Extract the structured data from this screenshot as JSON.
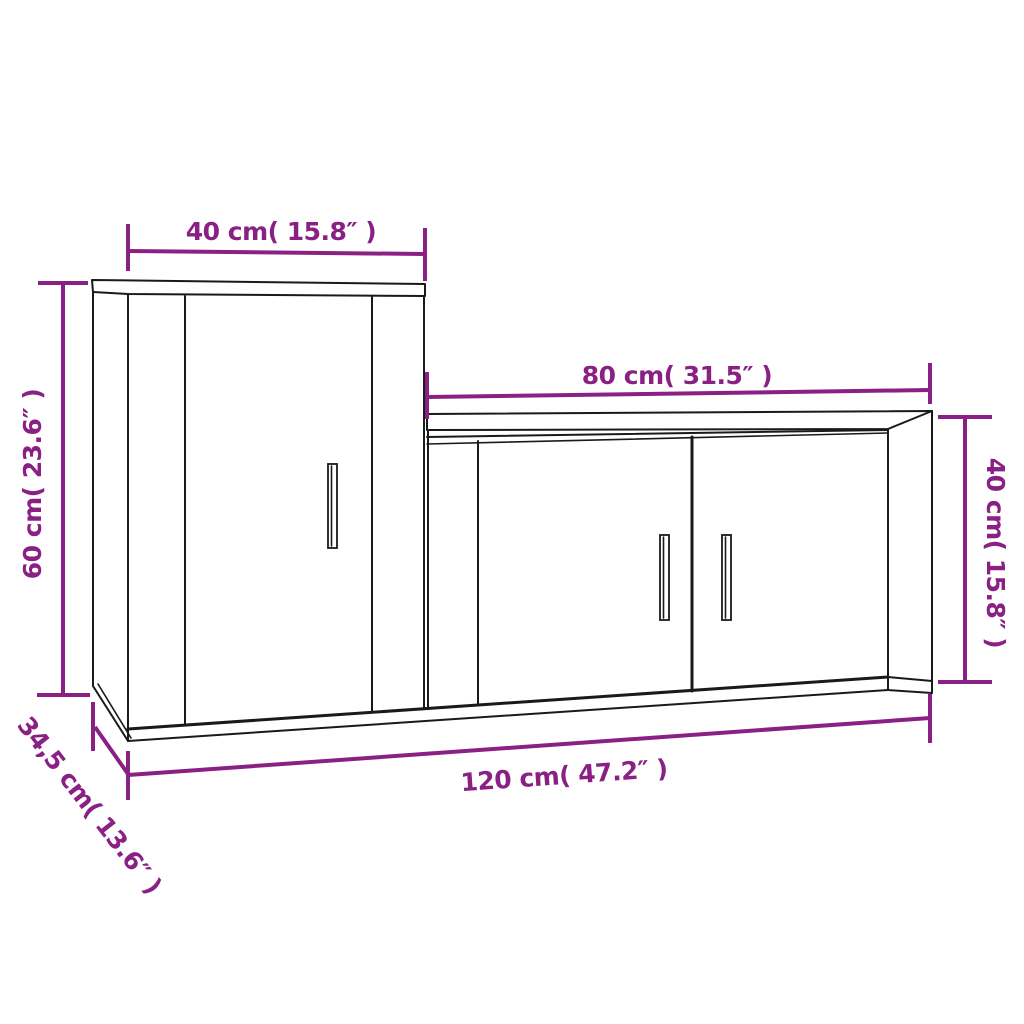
{
  "diagram": {
    "background": "#ffffff",
    "annotation_color": "#8A2084",
    "outline_color": "#1a1a1a",
    "dimensions": {
      "tall_cabinet_width": {
        "label": "40 cm( 15.8″ )",
        "value_cm": "40",
        "value_in": "15.8",
        "orientation": "horizontal",
        "location": "top of tall left cabinet"
      },
      "tall_cabinet_height": {
        "label": "60 cm( 23.6″ )",
        "value_cm": "60",
        "value_in": "23.6",
        "orientation": "vertical",
        "location": "left side of tall cabinet"
      },
      "low_cabinet_width": {
        "label": "80 cm( 31.5″ )",
        "value_cm": "80",
        "value_in": "31.5",
        "orientation": "horizontal",
        "location": "top of low right cabinet"
      },
      "low_cabinet_height": {
        "label": "40 cm( 15.8″ )",
        "value_cm": "40",
        "value_in": "15.8",
        "orientation": "vertical",
        "location": "right side of low cabinet"
      },
      "total_width": {
        "label": "120 cm( 47.2″ )",
        "value_cm": "120",
        "value_in": "47.2",
        "orientation": "horizontal",
        "location": "bottom overall width"
      },
      "depth": {
        "label": "34,5 cm( 13.6″ )",
        "value_cm": "34,5",
        "value_in": "13.6",
        "orientation": "diagonal",
        "location": "depth at lower left"
      }
    }
  }
}
